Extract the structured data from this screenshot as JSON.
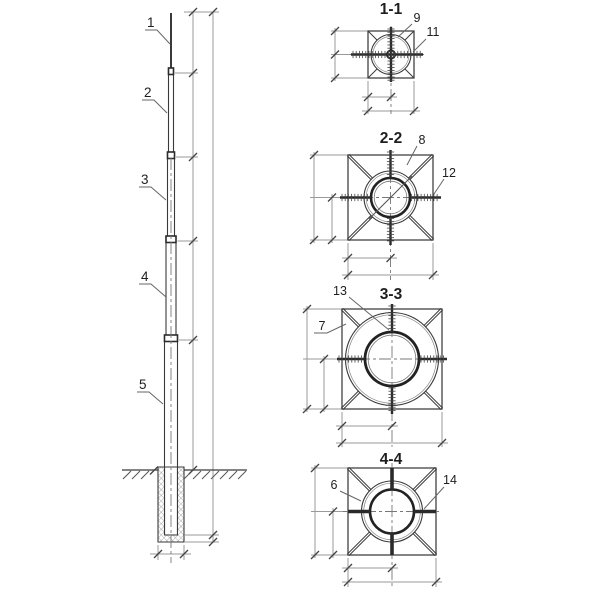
{
  "drawing": {
    "kind": "telescopic mast elevation with cross sections",
    "colors": {
      "background": "#ffffff",
      "line": "#3a3a3a",
      "dimension": "#9a9a9a",
      "text": "#1e1e1e"
    }
  },
  "elevation": {
    "part_labels": [
      "1",
      "2",
      "3",
      "4",
      "5"
    ]
  },
  "sections": [
    {
      "title": "1-1",
      "callouts": [
        "9",
        "11"
      ]
    },
    {
      "title": "2-2",
      "callouts": [
        "8",
        "12"
      ]
    },
    {
      "title": "3-3",
      "callouts": [
        "13",
        "7"
      ]
    },
    {
      "title": "4-4",
      "callouts": [
        "6",
        "14"
      ]
    }
  ]
}
